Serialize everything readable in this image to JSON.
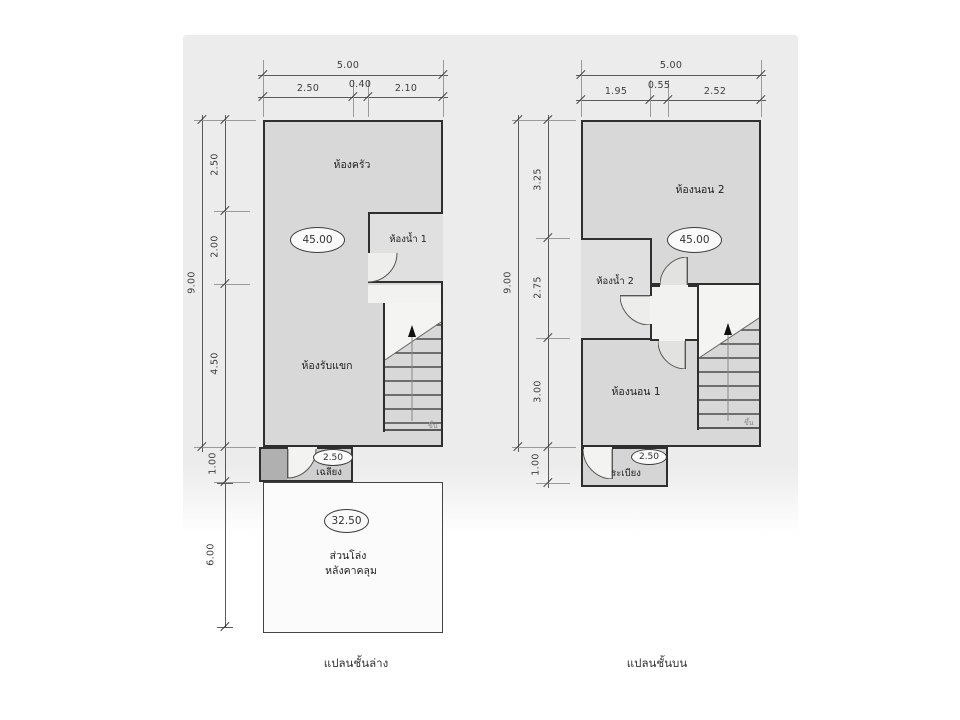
{
  "page": {
    "ground_caption": "แปลนชั้นล่าง",
    "upper_caption": "แปลนชั้นบน"
  },
  "colors": {
    "scan_background": "#ececec",
    "room_fill": "#d8d8d8",
    "wall": "#2f2f2f"
  },
  "ground": {
    "area_badge": "45.00",
    "porch_badge": "2.50",
    "open_badge": "32.50",
    "rooms": {
      "kitchen": "ห้องครัว",
      "bathroom": "ห้องน้ำ 1",
      "living": "ห้องรับแขก",
      "porch": "เฉลียง"
    },
    "open_area_line1": "ส่วนโล่ง",
    "open_area_line2": "หลังคาคลุม",
    "stair_mark": "ขึ้น",
    "dims": {
      "width_total": "5.00",
      "w1": "2.50",
      "w2": "0.40",
      "w3": "2.10",
      "height_total": "9.00",
      "h1": "2.50",
      "h2": "2.00",
      "h3": "4.50",
      "h4": "1.00",
      "open_height": "6.00"
    }
  },
  "upper": {
    "area_badge": "45.00",
    "balcony_badge": "2.50",
    "rooms": {
      "bedroom2": "ห้องนอน 2",
      "bathroom": "ห้องน้ำ 2",
      "bedroom1": "ห้องนอน 1",
      "balcony": "ระเบียง"
    },
    "stair_mark": "ขึ้น",
    "dims": {
      "width_total": "5.00",
      "w1": "1.95",
      "w2": "0.55",
      "w3": "2.52",
      "height_total": "9.00",
      "h1": "3.25",
      "h2": "2.75",
      "h3": "3.00",
      "h4": "1.00"
    }
  }
}
